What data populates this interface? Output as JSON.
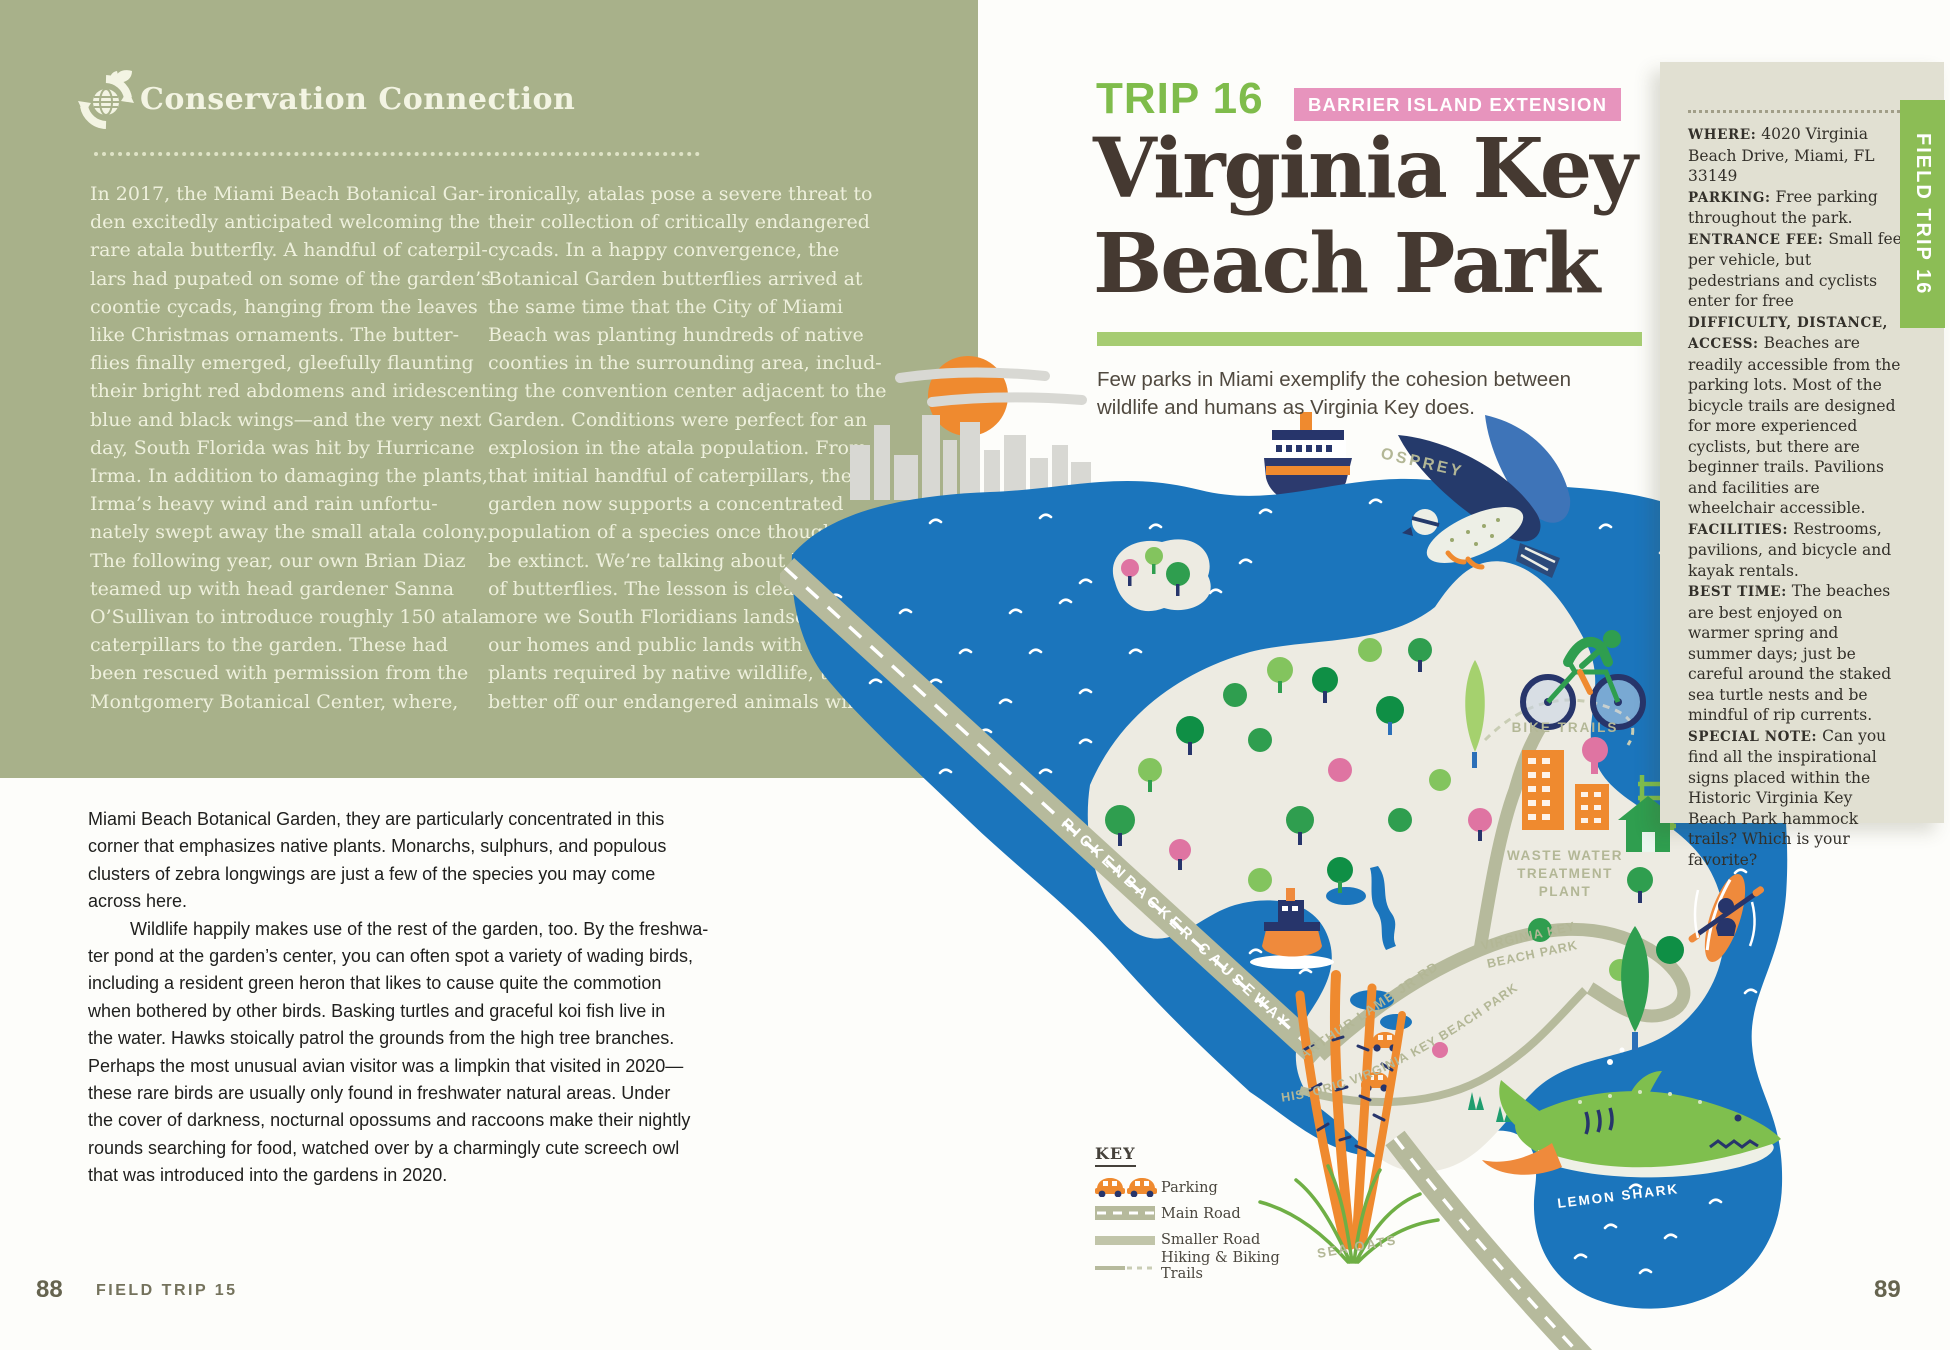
{
  "colors": {
    "conservation_green": "#a8b18a",
    "accent_green": "#7fbc4b",
    "bar_green": "#a6cc72",
    "tab_green": "#8cbd55",
    "badge_pink": "#e794bd",
    "title_brown": "#453931",
    "sidebar_beige": "#e1e0d2",
    "water_blue": "#1b75bc",
    "land_sand": "#edebe2",
    "road_olive": "#b6ba9c",
    "illustration_orange": "#ef8a2f",
    "illustration_navy": "#27356b"
  },
  "left_page": {
    "conservation": {
      "icon": "globe-recycle-leaves-icon",
      "title": "Conservation Connection",
      "col1": "In 2017, the Miami Beach Botanical Gar-\nden excitedly anticipated welcoming the\nrare atala butterfly. A handful of caterpil-\nlars had pupated on some of the garden’s\ncoontie cycads, hanging from the leaves\nlike Christmas ornaments. The butter-\nflies finally emerged, gleefully flaunting\ntheir bright red abdomens and iridescent\nblue and black wings—and the very next\nday, South Florida was hit by Hurricane\nIrma. In addition to damaging the plants,\nIrma’s heavy wind and rain unfortu-\nnately swept away the small atala colony.\nThe following year, our own Brian Diaz\nteamed up with head gardener Sanna\nO’Sullivan to introduce roughly 150 atala\ncaterpillars to the garden. These had\nbeen rescued with permission from the\nMontgomery Botanical Center, where,",
      "col2": "ironically, atalas pose a severe threat to\ntheir collection of critically endangered\ncycads. In a happy convergence, the\nBotanical Garden butterflies arrived at\nthe same time that the City of Miami\nBeach was planting hundreds of native\ncoonties in the surrounding area, includ-\ning the convention center adjacent to the\nGarden. Conditions were perfect for an\nexplosion in the atala population. From\nthat initial handful of caterpillars, the\ngarden now supports a concentrated\npopulation of a species once thought to\nbe extinct. We’re talking about hundreds\nof butterflies. The lesson is clear: the\nmore we South Floridians landscape\nour homes and public lands with native\nplants required by native wildlife, the\nbetter off our endangered animals will be."
    },
    "body_par1": "Miami Beach Botanical Garden, they are particularly concentrated in this\ncorner that emphasizes native plants. Monarchs, sulphurs, and populous\nclusters of zebra longwings are just a few of the species you may come\nacross here.",
    "body_par2": "Wildlife happily makes use of the rest of the garden, too. By the freshwa-\nter pond at the garden’s center, you can often spot a variety of wading birds,\nincluding a resident green heron that likes to cause quite the commotion\nwhen bothered by other birds. Basking turtles and graceful koi fish live in\nthe water. Hawks stoically patrol the grounds from the high tree branches.\nPerhaps the most unusual avian visitor was a limpkin that visited in 2020—\nthese rare birds are usually only found in freshwater natural areas. Under\nthe cover of darkness, nocturnal opossums and raccoons make their nightly\nrounds searching for food, watched over by a charmingly cute screech owl\nthat was introduced into the gardens in 2020.",
    "footer": {
      "page_number": "88",
      "label": "FIELD TRIP 15"
    }
  },
  "right_page": {
    "trip_label": "TRIP 16",
    "badge": "BARRIER ISLAND EXTENSION",
    "title": "Virginia Key\nBeach Park",
    "subtitle": "Few parks in Miami exemplify the cohesion between\nwildlife and humans as Virginia Key does.",
    "tab": "FIELD TRIP 16",
    "page_number": "89",
    "sidebar": {
      "items": [
        {
          "label": "WHERE:",
          "text": "4020 Virginia Beach Drive, Miami, FL 33149"
        },
        {
          "label": "PARKING:",
          "text": "Free parking throughout the park."
        },
        {
          "label": "ENTRANCE FEE:",
          "text": "Small fee per vehicle, but pedestrians and cyclists enter for free"
        },
        {
          "label": "DIFFICULTY, DISTANCE, ACCESS:",
          "text": "Beaches are readily accessible from the parking lots. Most of the bicycle trails are designed for more experienced cyclists, but there are beginner trails. Pavilions and facilities are wheelchair accessible."
        },
        {
          "label": "FACILITIES:",
          "text": "Restrooms, pavilions, and bicycle and kayak rentals."
        },
        {
          "label": "BEST TIME:",
          "text": "The beaches are best enjoyed on warmer spring and summer days; just be careful around the staked sea turtle nests and be mindful of rip currents."
        },
        {
          "label": "SPECIAL NOTE:",
          "text": "Can you find all the inspirational signs placed within the Historic Virginia Key Beach Park hammock trails? Which is your favorite?"
        }
      ]
    },
    "map": {
      "labels": {
        "osprey": "OSPREY",
        "bike_trails": "BIKE TRAILS",
        "waste_line1": "WASTE WATER",
        "waste_line2": "TREATMENT",
        "waste_line3": "PLANT",
        "virginia_line1": "VIRGINIA KEY",
        "virginia_line2": "BEACH PARK",
        "historic": "HISTORIC VIRGINIA KEY BEACH PARK",
        "causeway": "RICKENBACKER CAUSEWAY",
        "arthur": "ARTHUR LAMB JR RD",
        "lemon_shark": "LEMON SHARK",
        "sea_oats": "SEA OATS"
      },
      "legend": {
        "title": "KEY",
        "items": [
          {
            "icon": "parking-cars-icon",
            "label": "Parking"
          },
          {
            "icon": "main-road-icon",
            "label": "Main Road"
          },
          {
            "icon": "smaller-road-icon",
            "label": "Smaller Road"
          },
          {
            "icon": "trails-icon",
            "label": "Hiking & Biking Trails"
          }
        ]
      }
    }
  }
}
